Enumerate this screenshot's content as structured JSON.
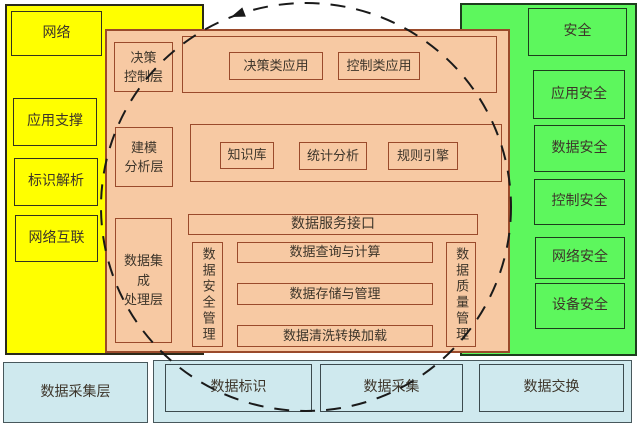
{
  "colors": {
    "yellow_panel": "#ffff00",
    "green_panel": "#5df75d",
    "orange_panel": "#f7c9a3",
    "orange_border": "#9a4a2b",
    "cyan_box": "#cfe9ee",
    "annotation_circle": "#1a1a1a",
    "text": "#3d352a"
  },
  "left_panel": {
    "items": [
      "网络",
      "应用支撑",
      "标识解析",
      "网络互联"
    ]
  },
  "right_panel": {
    "items": [
      "安全",
      "应用安全",
      "数据安全",
      "控制安全",
      "网络安全",
      "设备安全"
    ]
  },
  "platform": {
    "decision_layer": {
      "label_lines": [
        "决策",
        "控制层"
      ],
      "apps": [
        "决策类应用",
        "控制类应用"
      ]
    },
    "modeling_layer": {
      "label_lines": [
        "建模",
        "分析层"
      ],
      "modules": [
        "知识库",
        "统计分析",
        "规则引擎"
      ]
    },
    "integration_layer": {
      "label_lines": [
        "数据集",
        "成",
        "处理层"
      ],
      "service_interface": "数据服务接口",
      "left_vertical": "数据安全管理",
      "right_vertical": "数据质量管理",
      "functions": [
        "数据查询与计算",
        "数据存储与管理",
        "数据清洗转换加载"
      ]
    }
  },
  "bottom_layer": {
    "label": "数据采集层",
    "items": [
      "数据标识",
      "数据采集",
      "数据交换"
    ]
  }
}
